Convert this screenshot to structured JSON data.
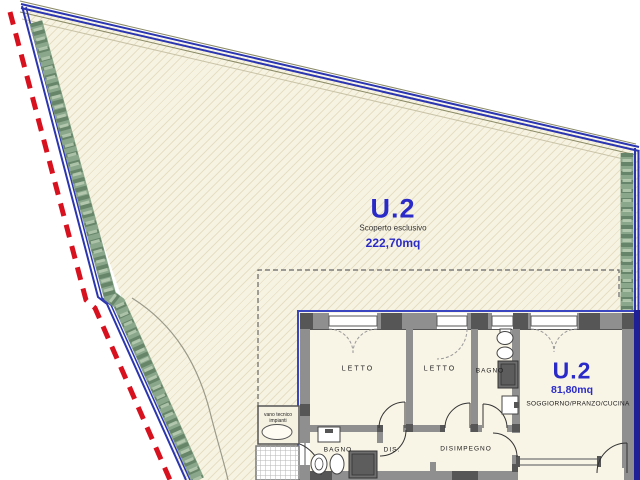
{
  "site": {
    "unit_label": "U.2",
    "area_type": "Scoperto esclusivo",
    "area_value": "222,70mq"
  },
  "unit": {
    "unit_label": "U.2",
    "area_value": "81,80mq",
    "main_room": "SOGGIORNO/PRANZO/CUCINA",
    "rooms": {
      "letto1": "LETTO",
      "letto2": "LETTO",
      "bagno1": "BAGNO",
      "bagno2": "BAGNO",
      "dis": "DIS.",
      "disimpegno": "DISIMPEGNO",
      "vano_line1": "vano tecnico",
      "vano_line2": "impianti"
    }
  },
  "colors": {
    "label_blue": "#2a2ac8",
    "boundary_blue": "#2b35b0",
    "boundary_navy_band": "#1f1f96",
    "boundary_red": "#d8111f",
    "hedge_green": "#8aa78c",
    "hedge_dark": "#59795e",
    "wall_gray": "#8f8f8f",
    "pier_dark": "#565656",
    "plot_cream": "#f7f3e2",
    "floor_cream": "#f8f4e6"
  }
}
